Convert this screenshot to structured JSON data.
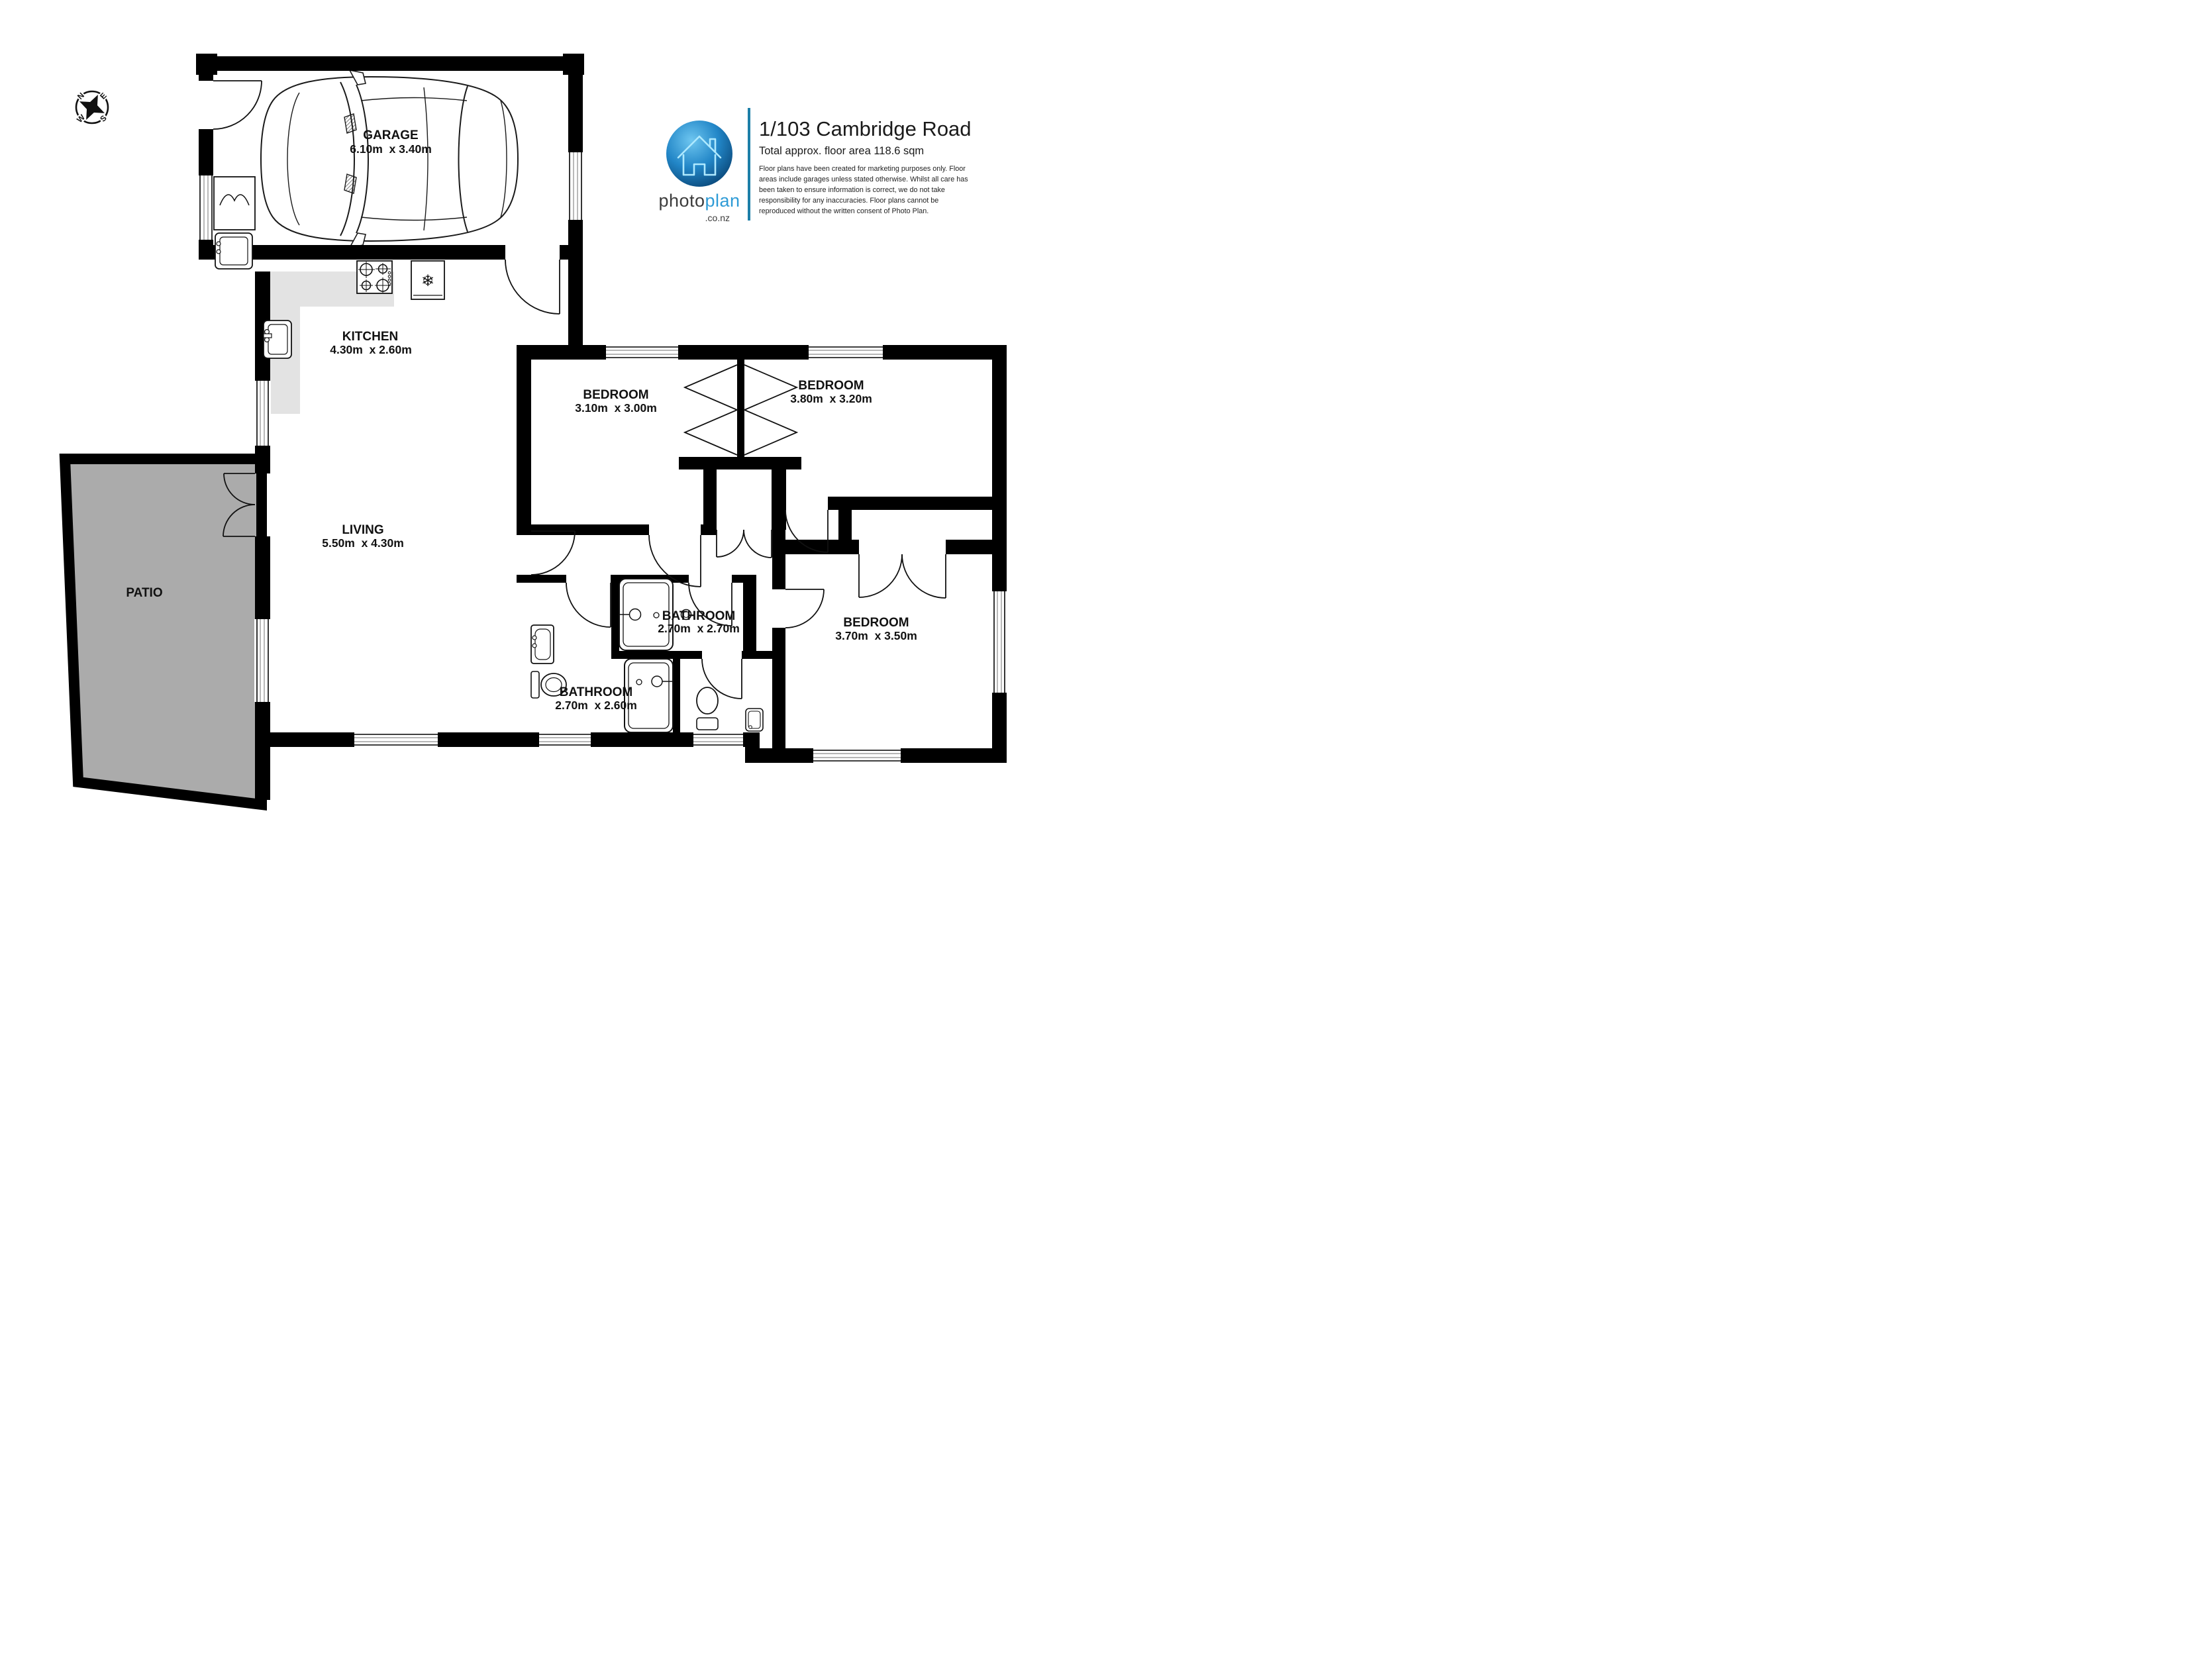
{
  "header": {
    "address": "1/103 Cambridge Road",
    "area": "Total approx. floor area 118.6 sqm",
    "disclaimer": [
      "Floor plans have been created for marketing purposes only. Floor",
      "areas include garages unless stated otherwise. Whilst all care has",
      "been taken to ensure information is correct, we do not take",
      "responsibility for any inaccuracies. Floor plans cannot be",
      "reproduced without the written consent of Photo Plan."
    ]
  },
  "logo": {
    "brand_photo": "photo",
    "brand_plan": "plan",
    "brand_domain": ".co.nz"
  },
  "compass": {
    "north": "N",
    "east": "E",
    "south": "S",
    "west": "W"
  },
  "rooms": {
    "garage": {
      "name": "GARAGE",
      "dims": "6.10m  x 3.40m"
    },
    "kitchen": {
      "name": "KITCHEN",
      "dims": "4.30m  x 2.60m"
    },
    "living": {
      "name": "LIVING",
      "dims": "5.50m  x 4.30m"
    },
    "patio": {
      "name": "PATIO"
    },
    "bedroom1": {
      "name": "BEDROOM",
      "dims": "3.10m  x 3.00m"
    },
    "bedroom2": {
      "name": "BEDROOM",
      "dims": "3.80m  x 3.20m"
    },
    "bedroom3": {
      "name": "BEDROOM",
      "dims": "3.70m  x 3.50m"
    },
    "bathroom1": {
      "name": "BATHROOM",
      "dims": "2.70m  x 2.70m"
    },
    "bathroom2": {
      "name": "BATHROOM",
      "dims": "2.70m  x 2.60m"
    }
  },
  "icons": {
    "snowflake": "❄"
  },
  "colors": {
    "wall": "#000000",
    "patio_fill": "#ababab",
    "counter_fill": "#e3e3e3",
    "logo_blue": "#2e9bd6",
    "logo_dark": "#3c3c3c",
    "divider_teal": "#1d7fa8"
  }
}
